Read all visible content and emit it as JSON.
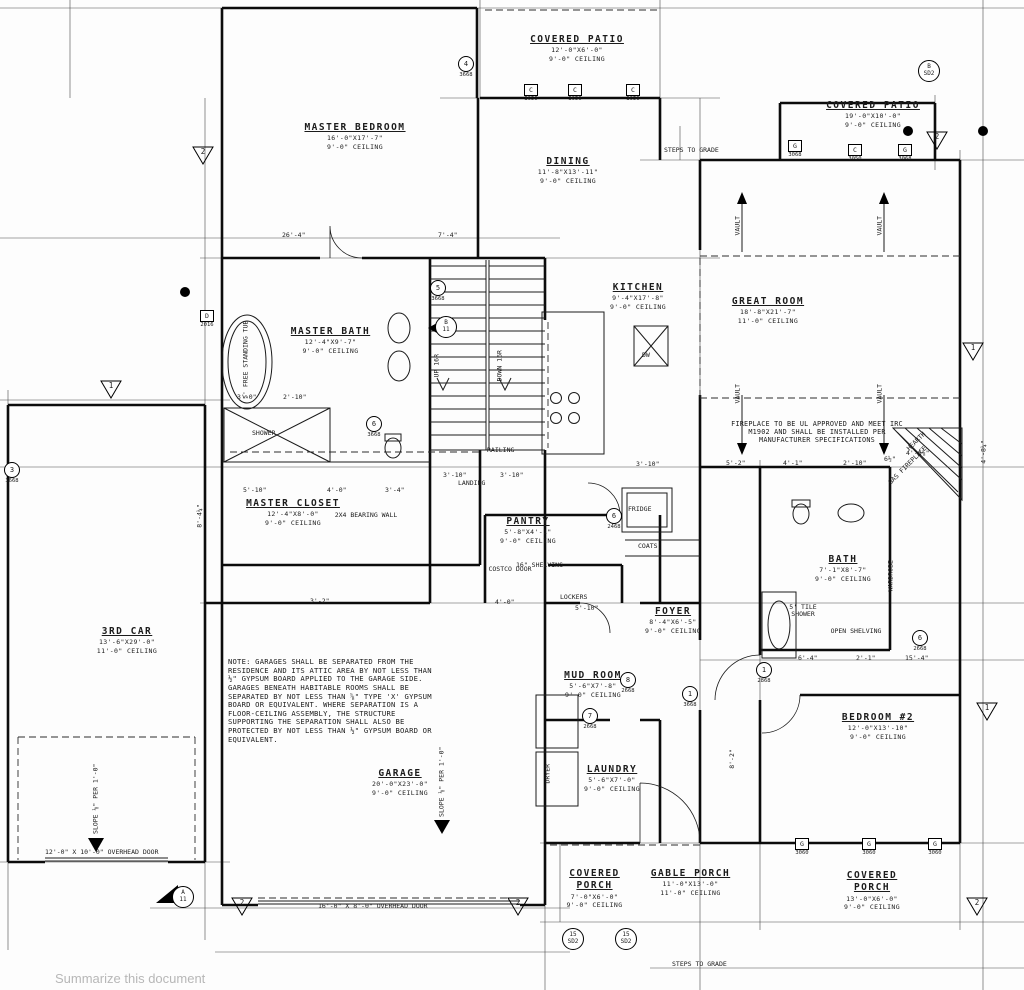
{
  "rooms": {
    "master_bedroom": {
      "name": "MASTER BEDROOM",
      "size": "16'-0\"X17'-7\"",
      "ceiling": "9'-0\" CEILING"
    },
    "covered_patio_top": {
      "name": "COVERED PATIO",
      "size": "12'-0\"X6'-0\"",
      "ceiling": "9'-0\" CEILING"
    },
    "covered_patio_right": {
      "name": "COVERED PATIO",
      "size": "19'-0\"X10'-0\"",
      "ceiling": "9'-0\" CEILING"
    },
    "dining": {
      "name": "DINING",
      "size": "11'-8\"X13'-11\"",
      "ceiling": "9'-0\" CEILING"
    },
    "kitchen": {
      "name": "KITCHEN",
      "size": "9'-4\"X17'-8\"",
      "ceiling": "9'-0\" CEILING"
    },
    "great_room": {
      "name": "GREAT ROOM",
      "size": "18'-8\"X21'-7\"",
      "ceiling": "11'-0\" CEILING"
    },
    "master_bath": {
      "name": "MASTER BATH",
      "size": "12'-4\"X9'-7\"",
      "ceiling": "9'-0\" CEILING"
    },
    "master_closet": {
      "name": "MASTER CLOSET",
      "size": "12'-4\"X8'-0\"",
      "ceiling": "9'-0\" CEILING"
    },
    "third_car": {
      "name": "3RD CAR",
      "size": "13'-6\"X29'-0\"",
      "ceiling": "11'-0\" CEILING"
    },
    "pantry": {
      "name": "PANTRY",
      "size": "5'-8\"X4'-1\"",
      "ceiling": "9'-0\" CEILING"
    },
    "foyer": {
      "name": "FOYER",
      "size": "8'-4\"X6'-5\"",
      "ceiling": "9'-0\" CEILING"
    },
    "mud_room": {
      "name": "MUD ROOM",
      "size": "5'-6\"X7'-8\"",
      "ceiling": "9'-0\" CEILING"
    },
    "laundry": {
      "name": "LAUNDRY",
      "size": "5'-6\"X7'-0\"",
      "ceiling": "9'-0\" CEILING"
    },
    "bath": {
      "name": "BATH",
      "size": "7'-1\"X8'-7\"",
      "ceiling": "9'-0\" CEILING"
    },
    "bedroom_2": {
      "name": "BEDROOM #2",
      "size": "12'-0\"X13'-10\"",
      "ceiling": "9'-0\" CEILING"
    },
    "garage": {
      "name": "GARAGE",
      "size": "20'-0\"X23'-0\"",
      "ceiling": "9'-0\" CEILING"
    },
    "covered_porch_bottom": {
      "name": "COVERED PORCH",
      "size": "7'-0\"X6'-0\"",
      "ceiling": "9'-0\" CEILING"
    },
    "gable_porch": {
      "name": "GABLE PORCH",
      "size": "11'-0\"X13'-0\"",
      "ceiling": "11'-0\" CEILING"
    },
    "covered_porch_right": {
      "name": "COVERED PORCH",
      "size": "13'-0\"X6'-0\"",
      "ceiling": "9'-0\" CEILING"
    }
  },
  "notes": {
    "garage_note": "NOTE: GARAGES SHALL BE SEPARATED FROM THE RESIDENCE AND ITS ATTIC AREA BY NOT LESS THAN ½\" GYPSUM BOARD APPLIED TO THE GARAGE SIDE. GARAGES BENEATH HABITABLE ROOMS SHALL BE SEPARATED BY NOT LESS THAN ⅝\" TYPE 'X' GYPSUM BOARD OR EQUIVALENT. WHERE SEPARATION IS A FLOOR-CEILING ASSEMBLY, THE STRUCTURE SUPPORTING THE SEPARATION SHALL ALSO BE PROTECTED BY NOT LESS THAN ½\" GYPSUM BOARD OR EQUIVALENT.",
    "fireplace_note": "FIREPLACE TO BE UL APPROVED AND MEET IRC M1902 AND SHALL BE INSTALLED PER MANUFACTURER SPECIFICATIONS"
  },
  "annotations": {
    "bearing_wall": "2X4 BEARING WALL",
    "tub": "5' FREE STANDING TUB",
    "shower": "SHOWER",
    "railing": "RAILING",
    "landing": "LANDING",
    "up": "UP 16R",
    "down": "DOWN 16R",
    "shelving": "16\" SHELVING",
    "lockers": "LOCKERS",
    "costco": "COSTCO DOOR",
    "fridge": "FRIDGE",
    "coats": "COATS",
    "dryer": "DRYER",
    "wardrobe": "WARDROBE",
    "tile_shower": "5' TILE SHOWER",
    "open_shelving": "OPEN SHELVING",
    "hearth": "HEARTH",
    "gas_fireplace": "GAS FIREPLACE",
    "vault": "VAULT",
    "steps_to_grade": "STEPS TO GRADE",
    "overhead_door_12": "12'-0\" X 10'-0\" OVERHEAD DOOR",
    "overhead_door_16": "16'-0\" X 8'-0\" OVERHEAD DOOR",
    "slope": "SLOPE ⅛\" PER 1'-0\"",
    "dw": "DW"
  },
  "dims": {
    "d26_4": "26'-4\"",
    "d7_4": "7'-4\"",
    "d5_10a": "5'-10\"",
    "d4_0a": "4'-0\"",
    "d3_4": "3'-4\"",
    "d3_0": "3'-0\"",
    "d2_10a": "2'-10\"",
    "d3_10a": "3'-10\"",
    "d3_10b": "3'-10\"",
    "d3_10c": "3'-10\"",
    "d5_2": "5'-2\"",
    "d4_1": "4'-1\"",
    "d2_10b": "2'-10\"",
    "d6_5": "6½\"",
    "d4_6": "4'-6⅞\"",
    "d6_4": "6'-4\"",
    "d2_1": "2'-1\"",
    "d15_4": "15'-4\"",
    "d4_0b": "4'-0\"",
    "d5_10b": "5'-10\"",
    "d3_2": "3'-2\"",
    "d8_4": "8'-4¼\"",
    "d8_2": "8'-2\"",
    "d4_8": "4'-8¼\""
  },
  "windows": {
    "w1": {
      "letter": "C",
      "size": "3050"
    },
    "w2": {
      "letter": "C",
      "size": "3050"
    },
    "w3": {
      "letter": "C",
      "size": "3050"
    },
    "w4": {
      "letter": "G",
      "size": "3068"
    },
    "w5": {
      "letter": "C",
      "size": "3050"
    },
    "w6": {
      "letter": "G",
      "size": "3068"
    },
    "w7": {
      "letter": "D",
      "size": "2016"
    },
    "w8": {
      "letter": "G",
      "size": "3060"
    },
    "w9": {
      "letter": "G",
      "size": "3060"
    },
    "w10": {
      "letter": "G",
      "size": "3060"
    }
  },
  "doors": {
    "d1": {
      "n": "4",
      "s": "3668"
    },
    "d2": {
      "n": "3",
      "s": "3668"
    },
    "d3": {
      "n": "5",
      "s": "3668"
    },
    "d4": {
      "n": "6",
      "s": "3668"
    },
    "d5": {
      "n": "6",
      "s": "2468"
    },
    "d6": {
      "n": "8",
      "s": "2668"
    },
    "d7": {
      "n": "7",
      "s": "2668"
    },
    "d8": {
      "n": "1",
      "s": "2868"
    },
    "d9": {
      "n": "6",
      "s": "2668"
    },
    "d10": {
      "n": "1",
      "s": "3668"
    }
  },
  "tris": {
    "t1": "2",
    "t2": "2",
    "t3": "2",
    "t4": "2",
    "t5": "2",
    "t6": "1",
    "t7": "1",
    "t8": "1"
  },
  "special": {
    "sd_top_n": "B",
    "sd_top_s": "SD2",
    "sd_b1_n": "15",
    "sd_b1_s": "SD2",
    "sd_b2_n": "15",
    "sd_b2_s": "SD2",
    "a11_n": "A",
    "a11_s": "11",
    "b11_n": "B",
    "b11_s": "11"
  },
  "ui": {
    "summarize_hint": "Summarize this document"
  }
}
